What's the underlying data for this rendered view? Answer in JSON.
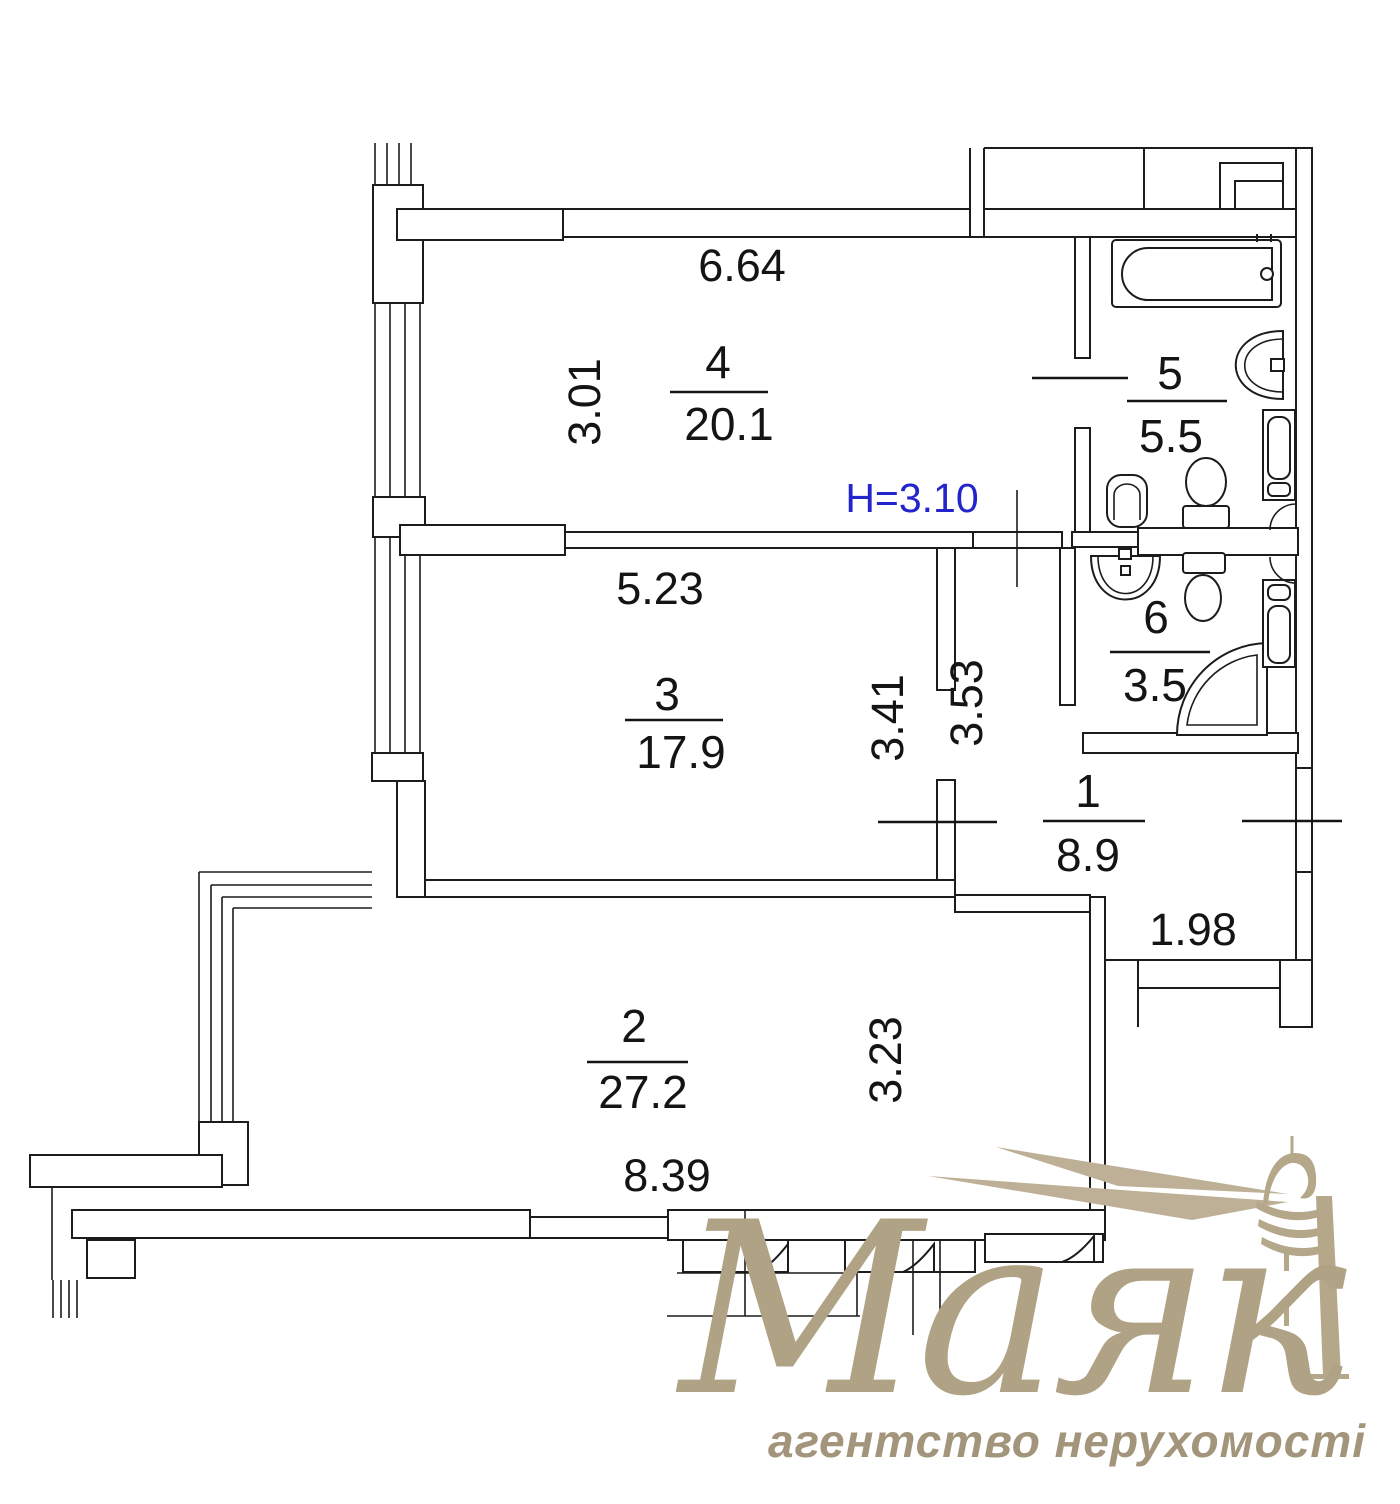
{
  "plan": {
    "ceiling": "H=3.10",
    "rooms": [
      {
        "id": "room-4",
        "number": "4",
        "area": "20.1"
      },
      {
        "id": "room-5",
        "number": "5",
        "area": "5.5"
      },
      {
        "id": "room-3",
        "number": "3",
        "area": "17.9"
      },
      {
        "id": "room-6",
        "number": "6",
        "area": "3.5"
      },
      {
        "id": "room-1",
        "number": "1",
        "area": "8.9"
      },
      {
        "id": "room-2",
        "number": "2",
        "area": "27.2"
      }
    ],
    "dims": {
      "top": "6.64",
      "room4_side": "3.01",
      "room3_top": "5.23",
      "room3_side": "3.41",
      "corridor_side": "3.53",
      "hall_step": "1.98",
      "room2_side": "3.23",
      "room2_bottom": "8.39"
    }
  },
  "watermark": {
    "brand": "Маяк",
    "tagline": "агентство нерухомості"
  },
  "colors": {
    "line": "#1c1c1c",
    "height_note": "#2424cc",
    "logo": "#b0a284",
    "logo_light": "#bdb096"
  }
}
